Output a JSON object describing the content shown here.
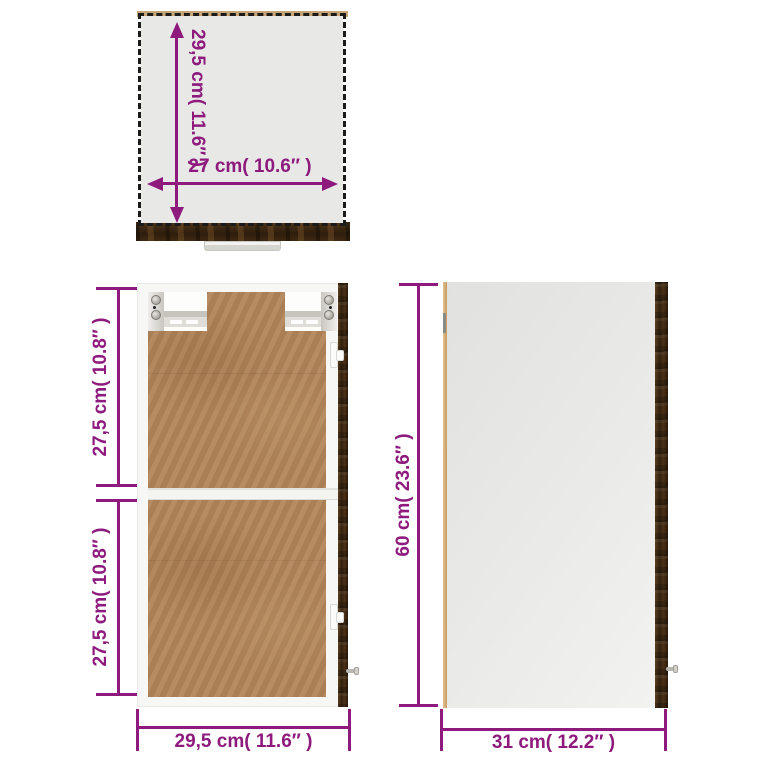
{
  "page": {
    "description": "Wall cabinet dimension diagram with top, front-interior and side views",
    "background": "#ffffff"
  },
  "views": {
    "top": {
      "depth_label": "29,5 cm( 11.6″ )",
      "width_label": "27 cm( 10.6″ )"
    },
    "front": {
      "upper_label": "27,5 cm( 10.8″ )",
      "lower_label": "27,5 cm( 10.8″ )",
      "width_label": "29,5 cm( 11.6″ )"
    },
    "side": {
      "height_label": "60 cm( 23.6″ )",
      "depth_label": "31 cm( 12.2″ )"
    }
  },
  "colors": {
    "dimension": "#8D1A7C",
    "dark_wood": "#3b2813",
    "hardboard_back": "#b3865a",
    "panel_gray": "#e7e7e6",
    "frame_white": "#f7f7f5",
    "edge_tan": "#d2a76e",
    "dashed_outline": "#1b1b1b"
  }
}
